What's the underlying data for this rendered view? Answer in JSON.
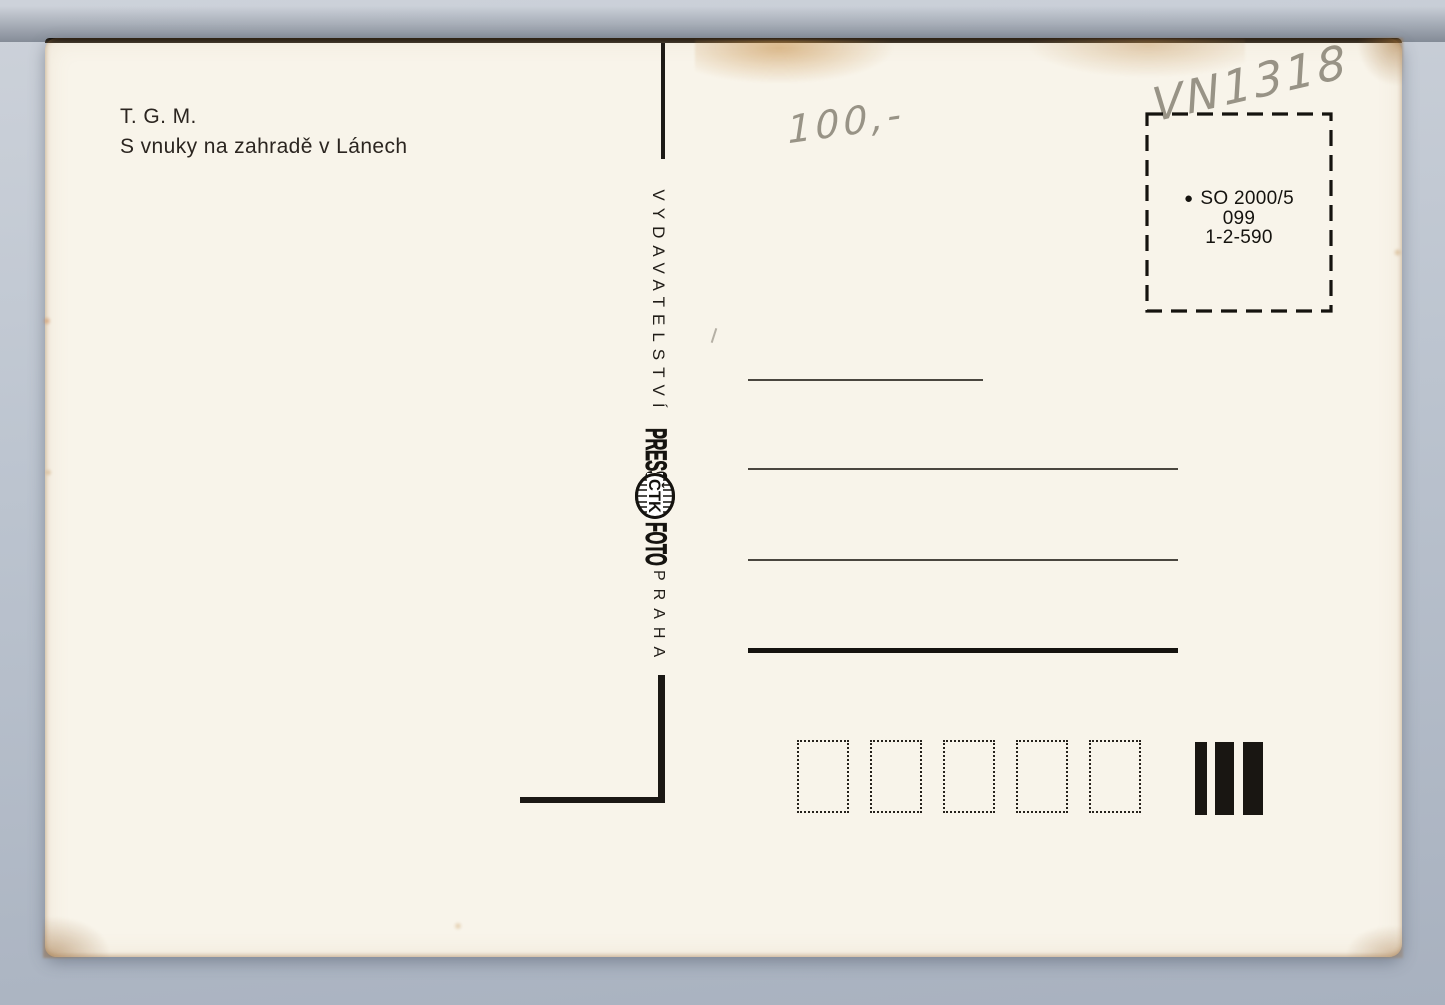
{
  "scan": {
    "background_color": "#b7bfcb",
    "paper_color": "#f8f4ea",
    "ink_color": "#15130f",
    "pencil_color": "#8b8679"
  },
  "postcard": {
    "caption": {
      "line1": "T. G. M.",
      "line2": "S vnuky na zahradě v Lánech"
    },
    "spine": {
      "publisher": "VYDAVATELSTVÍ",
      "logo": {
        "press": "PRESS",
        "agency": "ČTK",
        "foto": "FOTO"
      },
      "city": "PRAHA"
    },
    "stamp_box": {
      "bullet": "●",
      "series": "SO 2000/5",
      "code": "099",
      "print_run": "1-2-590"
    },
    "handwriting": {
      "inventory_number": "VN1318",
      "price": "100,-"
    }
  }
}
